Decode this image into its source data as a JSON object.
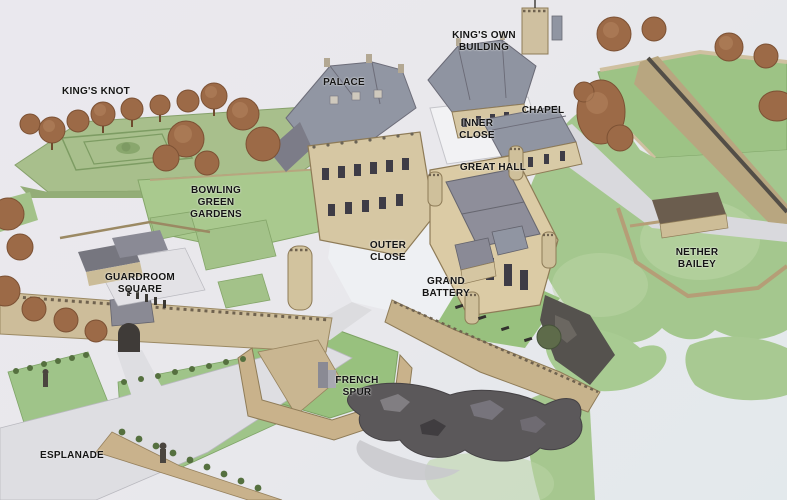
{
  "map": {
    "labels": [
      {
        "id": "kings-knot",
        "text": "KING'S KNOT",
        "x": 96,
        "y": 92
      },
      {
        "id": "palace",
        "text": "PALACE",
        "x": 344,
        "y": 83
      },
      {
        "id": "kings-own-building",
        "text": "KING'S OWN\nBUILDING",
        "x": 484,
        "y": 42
      },
      {
        "id": "chapel",
        "text": "CHAPEL",
        "x": 543,
        "y": 111
      },
      {
        "id": "inner-close",
        "text": "INNER\nCLOSE",
        "x": 477,
        "y": 130
      },
      {
        "id": "great-hall",
        "text": "GREAT HALL",
        "x": 493,
        "y": 168
      },
      {
        "id": "bowling-green-gardens",
        "text": "BOWLING\nGREEN\nGARDENS",
        "x": 216,
        "y": 203
      },
      {
        "id": "outer-close",
        "text": "OUTER\nCLOSE",
        "x": 388,
        "y": 252
      },
      {
        "id": "grand-battery",
        "text": "GRAND\nBATTERY",
        "x": 446,
        "y": 288
      },
      {
        "id": "guardroom-square",
        "text": "GUARDROOM\nSQUARE",
        "x": 140,
        "y": 284
      },
      {
        "id": "nether-bailey",
        "text": "NETHER\nBAILEY",
        "x": 697,
        "y": 259
      },
      {
        "id": "french-spur",
        "text": "FRENCH\nSPUR",
        "x": 357,
        "y": 387
      },
      {
        "id": "esplanade",
        "text": "ESPLANADE",
        "x": 72,
        "y": 456
      }
    ],
    "colors": {
      "background": "#e9e8ee",
      "grass": "#a4c78e",
      "lawn_bright": "#98c17e",
      "stone_wall": "#cdbd9a",
      "building_stone": "#d6c7a3",
      "roof_slate": "#9095a2",
      "roof_dark": "#6e6e78",
      "tree_russet": "#9c6a47",
      "rock": "#5b585a",
      "path": "#dedee2",
      "label_text": "#141414"
    }
  }
}
